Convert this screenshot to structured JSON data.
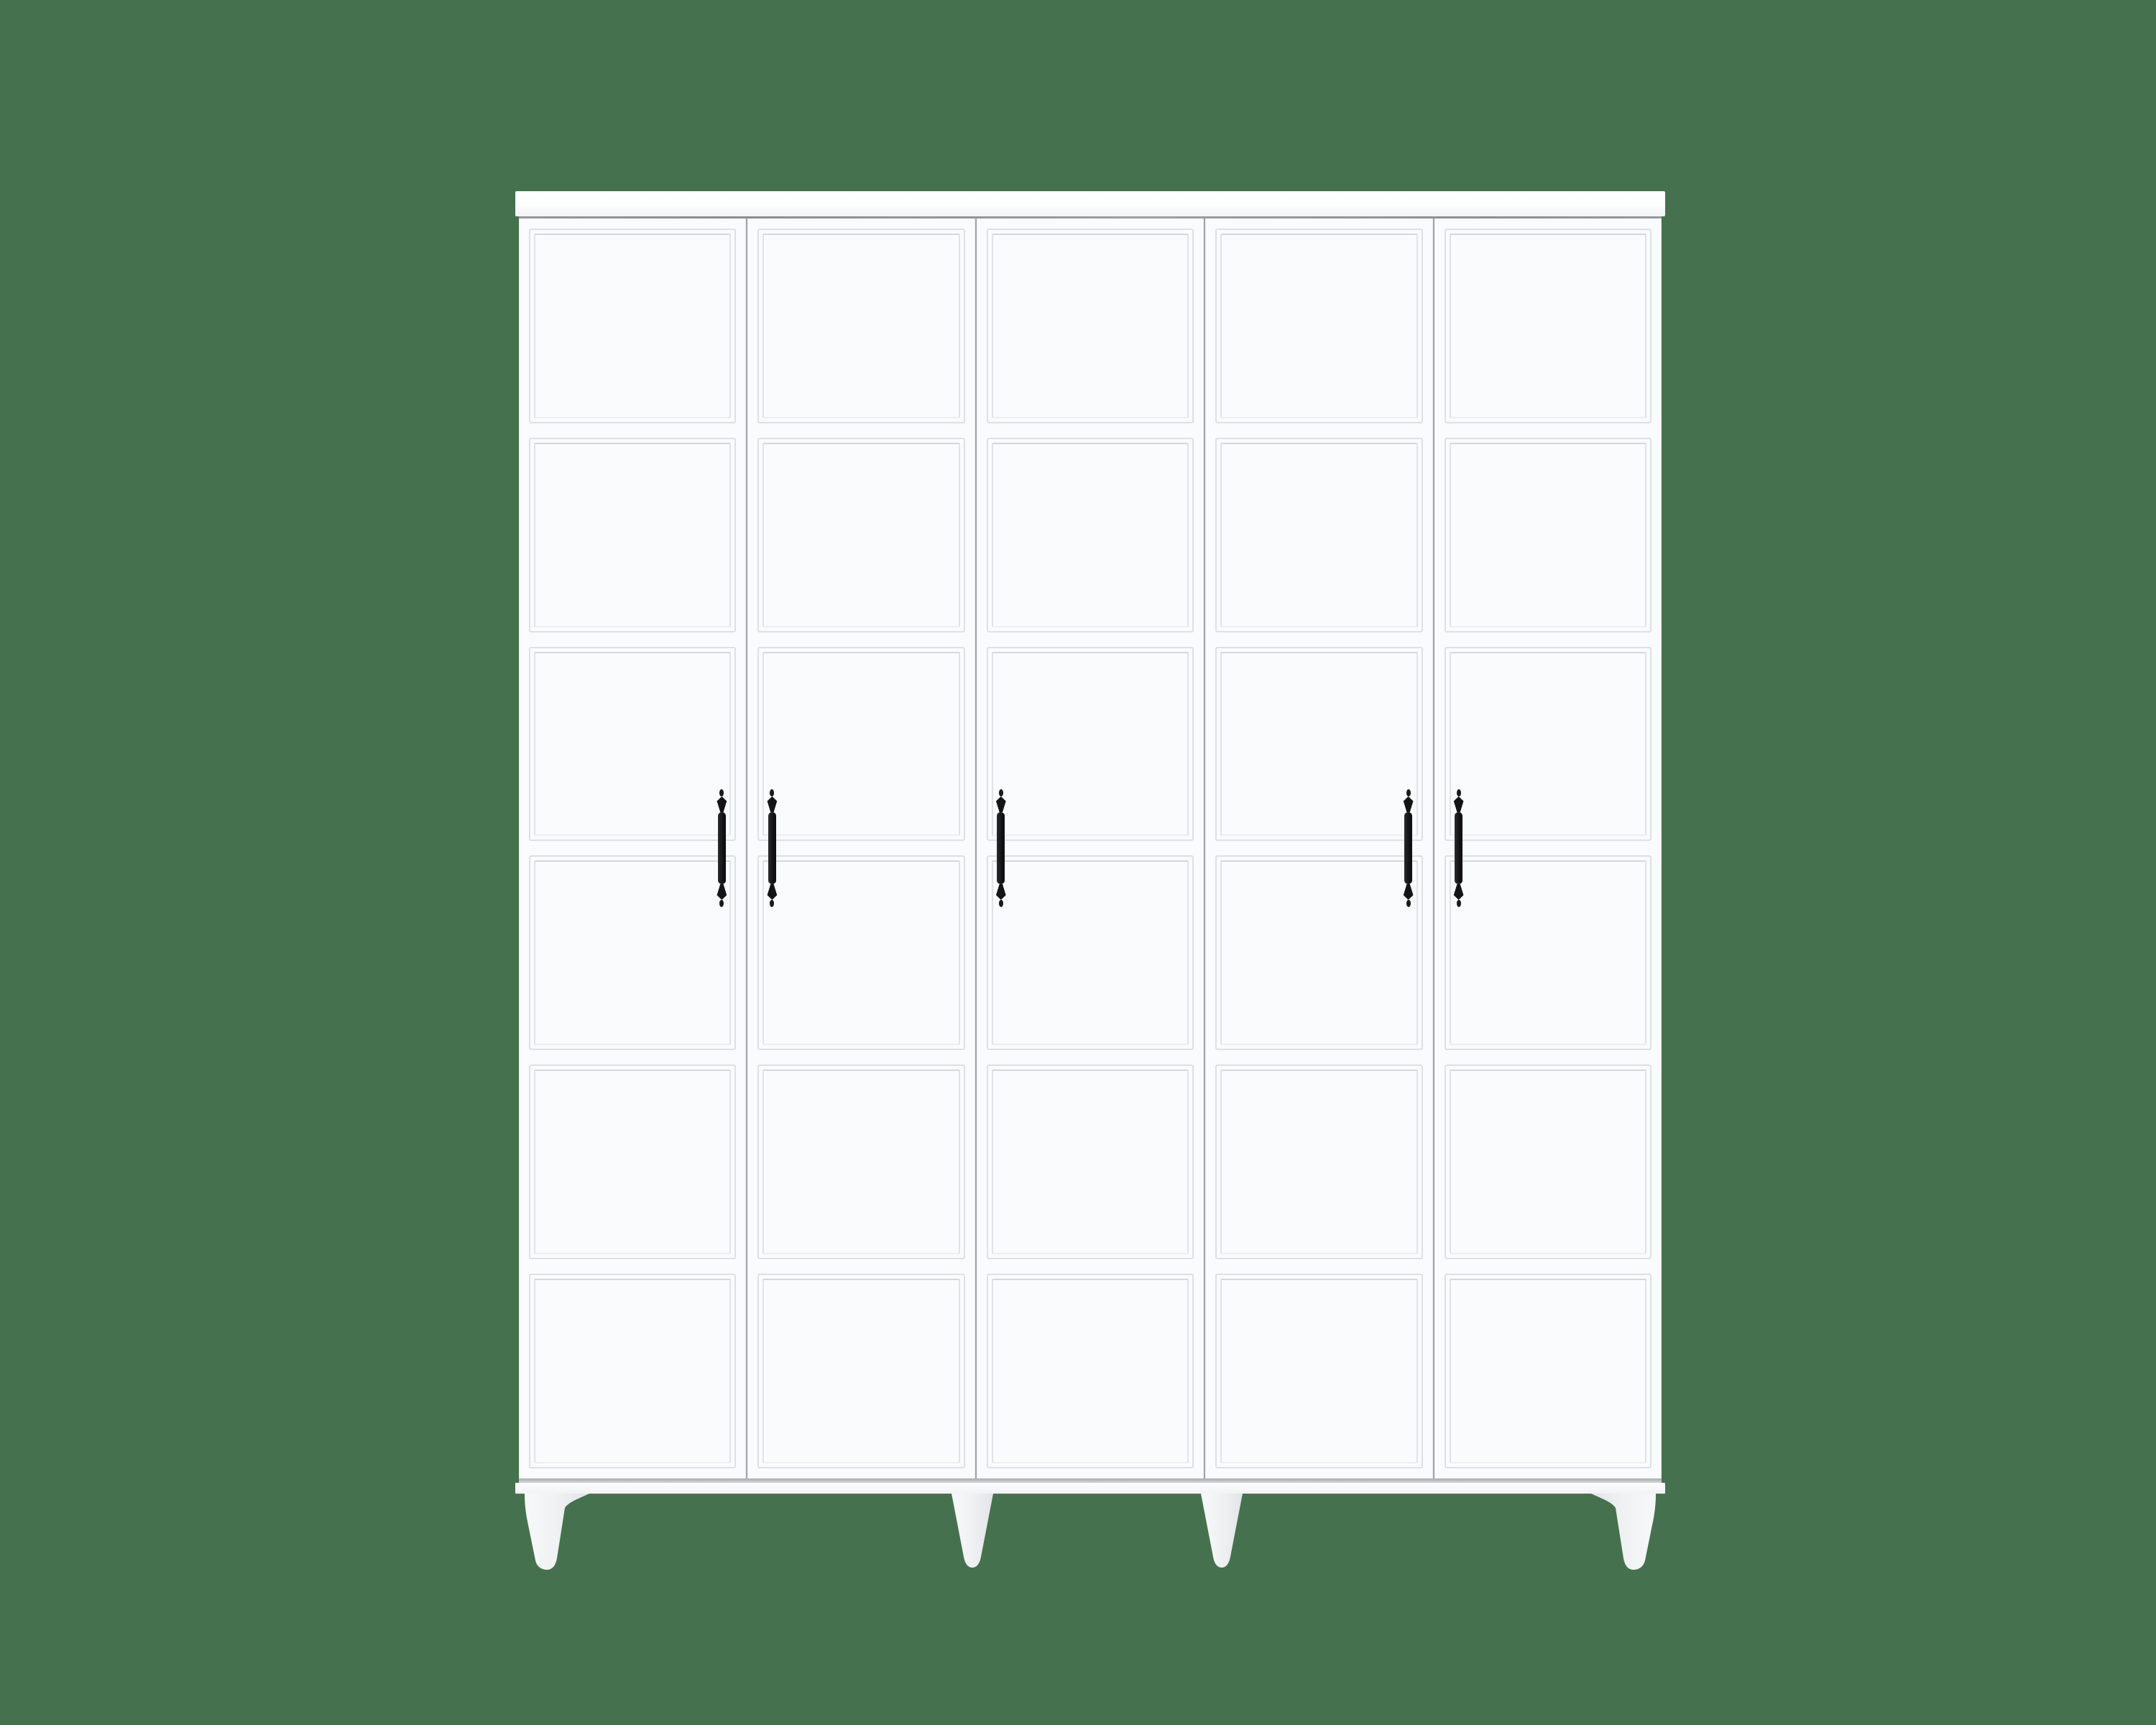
{
  "scene": {
    "description": "Front-view product render of a white wardrobe on a plain green backdrop",
    "background_color": "#46714E"
  },
  "wardrobe": {
    "name": "five-door paneled wardrobe",
    "door_color": "#fafbfd",
    "top_board_color": "#fdfdfe",
    "seam_color": "#a2a5a9",
    "panel_groove_color": "#dde0e4",
    "handle_color": "#1a1a1c",
    "leg_color": "#eff1f3",
    "panel_count_per_door": 6,
    "doors": [
      {
        "id": 1,
        "handle_side": "right",
        "panel_count": 6
      },
      {
        "id": 2,
        "handle_side": "left",
        "panel_count": 6
      },
      {
        "id": 3,
        "handle_side": "left",
        "panel_count": 6
      },
      {
        "id": 4,
        "handle_side": "right",
        "panel_count": 6
      },
      {
        "id": 5,
        "handle_side": "left",
        "panel_count": 6
      }
    ],
    "legs": [
      {
        "position": "far-left",
        "style": "splayed-outward"
      },
      {
        "position": "center-left",
        "style": "straight-taper"
      },
      {
        "position": "center-right",
        "style": "straight-taper"
      },
      {
        "position": "far-right",
        "style": "splayed-outward"
      }
    ]
  }
}
